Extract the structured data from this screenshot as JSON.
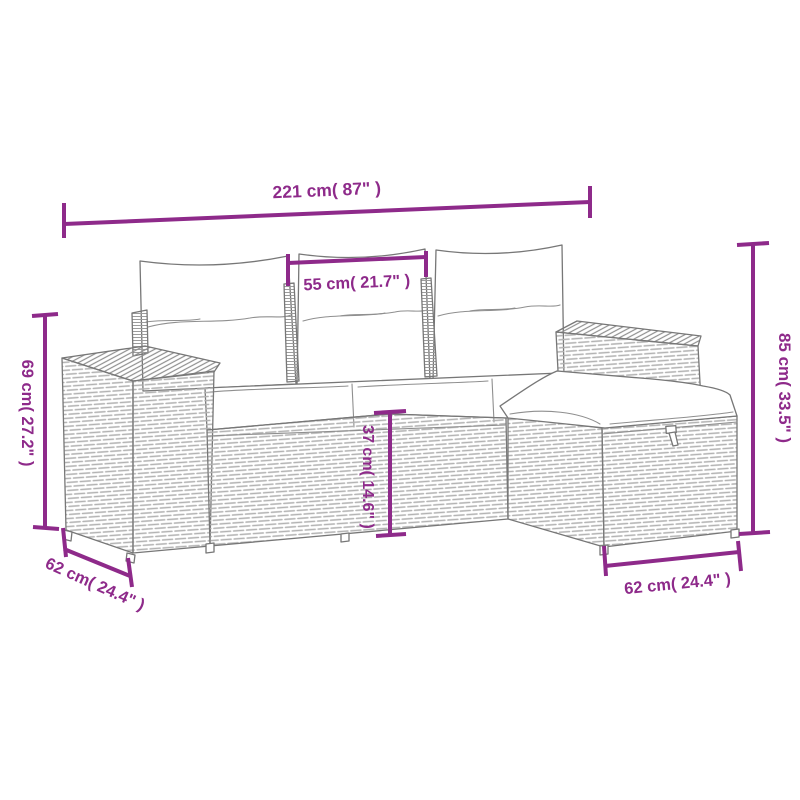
{
  "diagram": {
    "type": "product-dimension-diagram",
    "subject": "4-piece poly rattan garden lounge set (3-seat sofa with cushions and ottoman), line-art",
    "background_color": "#ffffff",
    "accent_color": "#8e2a8a",
    "lineart_color": "#777777"
  },
  "dimensions": {
    "total_width": {
      "cm": 221,
      "inches": 87,
      "label": "221 cm( 87\" )"
    },
    "seat_width": {
      "cm": 55,
      "inches": 21.7,
      "label": "55 cm( 21.7\" )"
    },
    "back_height": {
      "cm": 85,
      "inches": 33.5,
      "label": "85 cm( 33.5\" )"
    },
    "arm_height": {
      "cm": 69,
      "inches": 27.2,
      "label": "69 cm( 27.2\" )"
    },
    "seat_height": {
      "cm": 37,
      "inches": 14.6,
      "label": "37 cm( 14.6\" )"
    },
    "left_depth": {
      "cm": 62,
      "inches": 24.4,
      "label": "62 cm( 24.4\" )"
    },
    "ottoman_depth": {
      "cm": 62,
      "inches": 24.4,
      "label": "62 cm( 24.4\" )"
    }
  }
}
